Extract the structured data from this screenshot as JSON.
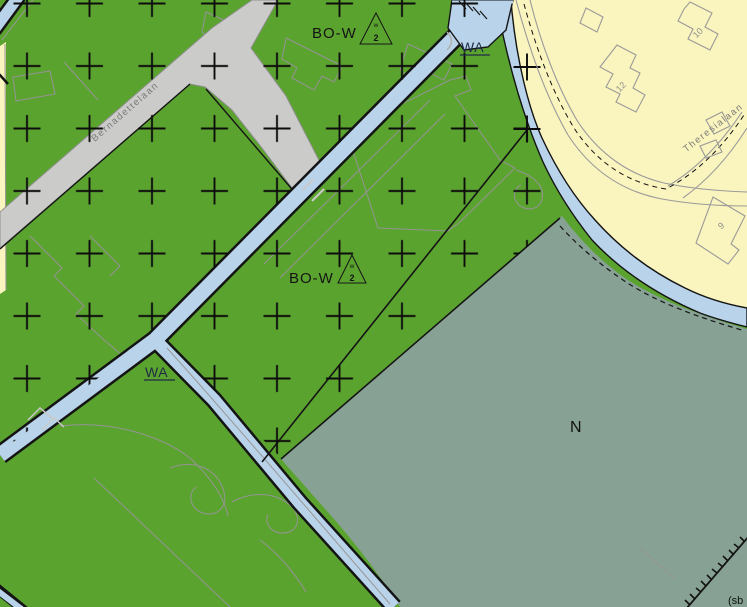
{
  "map": {
    "labels": {
      "zone_bo_w_top": "BO-W",
      "zone_bo_w_center": "BO-W",
      "water_top": "WA",
      "water_left": "WA",
      "nature": "N",
      "corner_note": "(sb",
      "triangle_top": {
        "letter": "w",
        "number": "2"
      },
      "triangle_center": {
        "letter": "w",
        "number": "2"
      }
    },
    "streets": {
      "bernadettelaan": "Bernadettelaan",
      "theresialaan": "Theresialaan"
    },
    "house_numbers": {
      "n10": "10",
      "n12": "12",
      "n9": "9"
    },
    "colors": {
      "agricultural_green": "#5ba32f",
      "water_blue": "#b9d4ea",
      "residential_yellow": "#faf4be",
      "nature_gray_green": "#87a294",
      "road_gray": "#cbcbca",
      "boundary_black": "#141414",
      "parcel_gray": "#949494",
      "water_label_blue": "#1f2a44"
    }
  }
}
